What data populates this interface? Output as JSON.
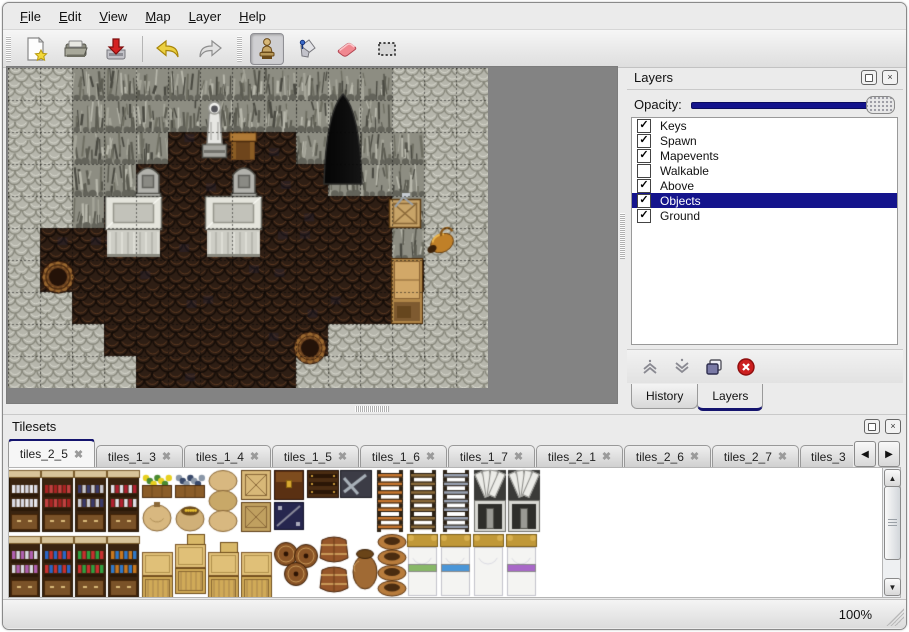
{
  "menu": {
    "items": [
      {
        "first": "F",
        "rest": "ile"
      },
      {
        "first": "E",
        "rest": "dit"
      },
      {
        "first": "V",
        "rest": "iew"
      },
      {
        "first": "M",
        "rest": "ap"
      },
      {
        "first": "L",
        "rest": "ayer"
      },
      {
        "first": "H",
        "rest": "elp"
      }
    ]
  },
  "toolbar": {
    "buttons": [
      {
        "name": "new-map",
        "icon": "new-file-icon"
      },
      {
        "name": "open-map",
        "icon": "open-folder-icon"
      },
      {
        "name": "save-map",
        "icon": "save-icon"
      },
      {
        "name": "undo",
        "icon": "undo-arrow-icon"
      },
      {
        "name": "redo",
        "icon": "redo-arrow-icon"
      },
      {
        "name": "stamp-tool",
        "icon": "stamp-icon",
        "active": true
      },
      {
        "name": "fill-tool",
        "icon": "paint-bucket-icon"
      },
      {
        "name": "eraser-tool",
        "icon": "eraser-icon"
      },
      {
        "name": "select-tool",
        "icon": "selection-icon"
      }
    ]
  },
  "layers_panel": {
    "title": "Layers",
    "opacity_label": "Opacity:",
    "opacity_percent": 100,
    "layers": [
      {
        "name": "Keys",
        "checked": true,
        "selected": false
      },
      {
        "name": "Spawn",
        "checked": true,
        "selected": false
      },
      {
        "name": "Mapevents",
        "checked": true,
        "selected": false
      },
      {
        "name": "Walkable",
        "checked": false,
        "selected": false
      },
      {
        "name": "Above",
        "checked": true,
        "selected": false
      },
      {
        "name": "Objects",
        "checked": true,
        "selected": true
      },
      {
        "name": "Ground",
        "checked": true,
        "selected": false
      }
    ],
    "bottom_tabs": [
      {
        "label": "History",
        "active": false
      },
      {
        "label": "Layers",
        "active": true
      }
    ],
    "selected_color": "#14148c"
  },
  "map_view": {
    "tile_size": 32,
    "legend": {
      "W": "rock-wall",
      "C": "cliff-face",
      "F": "dirt-floor"
    },
    "grid_rows": [
      "WWCCCCCCCCCCWWW",
      "WWCCCCCCCCCCWWW",
      "WWCCCFFFFCCCCWW",
      "WWCCFFFFFFCCCWW",
      "WWCFFFFFFFFFCWW",
      "WFFFFFFFFFFFCWW",
      "WFFFFFFFFFFFFWW",
      "WWFFFFFFFFFFWWW",
      "WWWFFFFFFFWWWWW",
      "WWWWFFFFFWWWWWW"
    ],
    "objects": [
      {
        "type": "cave-entrance",
        "x": 316,
        "y": 26
      },
      {
        "type": "statue",
        "x": 192,
        "y": 30
      },
      {
        "type": "table",
        "x": 221,
        "y": 64
      },
      {
        "type": "tombstone",
        "x": 127,
        "y": 97
      },
      {
        "type": "tombstone",
        "x": 223,
        "y": 97
      },
      {
        "type": "platform",
        "x": 97,
        "y": 128
      },
      {
        "type": "platform",
        "x": 197,
        "y": 128
      },
      {
        "type": "barrel",
        "x": 33,
        "y": 192
      },
      {
        "type": "crate-tools",
        "x": 381,
        "y": 125
      },
      {
        "type": "gold-pot",
        "x": 417,
        "y": 158
      },
      {
        "type": "cabinet",
        "x": 383,
        "y": 190
      },
      {
        "type": "barrel",
        "x": 285,
        "y": 263
      }
    ],
    "colors": {
      "wall_base": "#b6b6ac",
      "cliff_base": "#8d8d82",
      "floor_base": "#2e1e14",
      "bg": "#838383"
    }
  },
  "tilesets_panel": {
    "title": "Tilesets",
    "tabs": [
      {
        "label": "tiles_2_5",
        "active": true
      },
      {
        "label": "tiles_1_3",
        "active": false
      },
      {
        "label": "tiles_1_4",
        "active": false
      },
      {
        "label": "tiles_1_5",
        "active": false
      },
      {
        "label": "tiles_1_6",
        "active": false
      },
      {
        "label": "tiles_1_7",
        "active": false
      },
      {
        "label": "tiles_2_1",
        "active": false
      },
      {
        "label": "tiles_2_6",
        "active": false
      },
      {
        "label": "tiles_2_7",
        "active": false
      },
      {
        "label": "tiles_3",
        "active": false,
        "truncated": true
      }
    ],
    "tiles": [
      {
        "type": "shelf",
        "x": 0,
        "y": 2,
        "palette": [
          "#e8e8ee",
          "#d8d8e2"
        ]
      },
      {
        "type": "shelf",
        "x": 33,
        "y": 2,
        "palette": [
          "#a82222",
          "#c04040"
        ]
      },
      {
        "type": "shelf",
        "x": 66,
        "y": 2,
        "palette": [
          "#3a3a6a",
          "#c8c8d0"
        ]
      },
      {
        "type": "shelf",
        "x": 99,
        "y": 2,
        "palette": [
          "#e0e0e8",
          "#b02030"
        ]
      },
      {
        "type": "planter",
        "x": 133,
        "y": 2,
        "palette": [
          "#e8d020",
          "#4a8a30"
        ]
      },
      {
        "type": "planter",
        "x": 166,
        "y": 2,
        "palette": [
          "#8a97a8",
          "#39496a"
        ]
      },
      {
        "type": "sack",
        "x": 133,
        "y": 32
      },
      {
        "type": "sack-open",
        "x": 166,
        "y": 32
      },
      {
        "type": "sack-stack",
        "x": 199,
        "y": 2
      },
      {
        "type": "crate-x",
        "x": 232,
        "y": 2,
        "tone": "#d8b878"
      },
      {
        "type": "crate-x",
        "x": 232,
        "y": 34,
        "tone": "#c0a060"
      },
      {
        "type": "chest",
        "x": 265,
        "y": 2
      },
      {
        "type": "crate-navy",
        "x": 265,
        "y": 34
      },
      {
        "type": "chest-bands",
        "x": 298,
        "y": 2
      },
      {
        "type": "chest-metal",
        "x": 331,
        "y": 2
      },
      {
        "type": "ladder",
        "x": 366,
        "y": 2,
        "tone": "#c87830"
      },
      {
        "type": "ladder",
        "x": 399,
        "y": 2,
        "tone": "#8a6a3a"
      },
      {
        "type": "ladder",
        "x": 432,
        "y": 2,
        "tone": "#9aa2b2"
      },
      {
        "type": "stone-door",
        "x": 465,
        "y": 2
      },
      {
        "type": "stone-door",
        "x": 499,
        "y": 2
      },
      {
        "type": "shelf",
        "x": 0,
        "y": 68,
        "palette": [
          "#b060b0",
          "#d8d8e0"
        ]
      },
      {
        "type": "shelf",
        "x": 33,
        "y": 68,
        "palette": [
          "#2a66c8",
          "#c83030"
        ]
      },
      {
        "type": "shelf",
        "x": 66,
        "y": 68,
        "palette": [
          "#30a040",
          "#c83030"
        ]
      },
      {
        "type": "shelf",
        "x": 99,
        "y": 68,
        "palette": [
          "#c87820",
          "#3078c8"
        ]
      },
      {
        "type": "crate-stack",
        "x": 133,
        "y": 74,
        "top": false
      },
      {
        "type": "crate-stack",
        "x": 166,
        "y": 66,
        "top": true
      },
      {
        "type": "crate-stack",
        "x": 199,
        "y": 74,
        "top": true
      },
      {
        "type": "crate-stack",
        "x": 232,
        "y": 74,
        "top": false
      },
      {
        "type": "barrels-tumbled",
        "x": 265,
        "y": 74
      },
      {
        "type": "barrels-upright",
        "x": 310,
        "y": 68
      },
      {
        "type": "pot",
        "x": 343,
        "y": 76
      },
      {
        "type": "pot-stack",
        "x": 368,
        "y": 66
      },
      {
        "type": "bed",
        "x": 398,
        "y": 66,
        "trim": "#88b868"
      },
      {
        "type": "bed",
        "x": 431,
        "y": 66,
        "trim": "#4a96d8"
      },
      {
        "type": "bed",
        "x": 464,
        "y": 66,
        "trim": null
      },
      {
        "type": "bed",
        "x": 497,
        "y": 66,
        "trim": "#a868c8"
      }
    ]
  },
  "status_bar": {
    "zoom": "100%"
  }
}
